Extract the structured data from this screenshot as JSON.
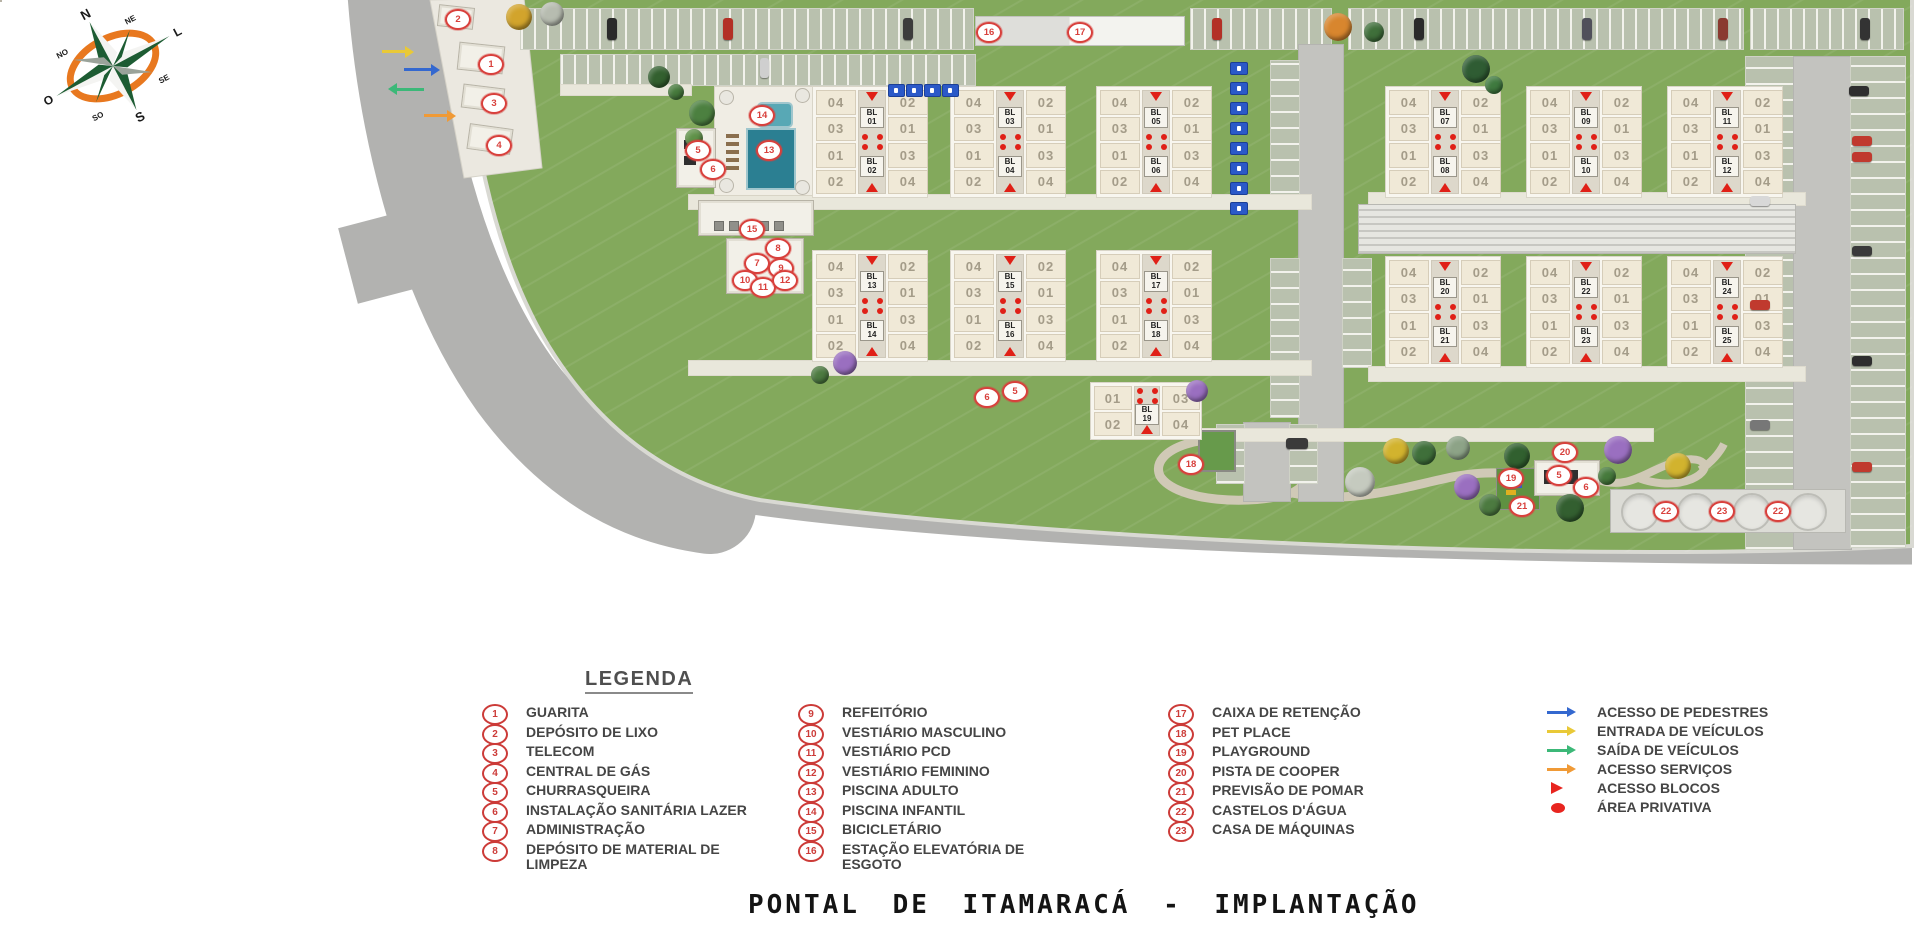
{
  "title": "PONTAL DE ITAMARACÁ - IMPLANTAÇÃO",
  "colors": {
    "accent_red": "#d8403c",
    "grass": "#83a95c",
    "road": "#b2b2b0",
    "building_cream": "#f0e9d7",
    "arrow_blue": "#3468cf",
    "arrow_yellow": "#e9c937",
    "arrow_green": "#3cb878",
    "arrow_orange": "#f09a36"
  },
  "compass": {
    "labels": [
      "N",
      "NE",
      "L",
      "SE",
      "S",
      "SO",
      "O",
      "NO"
    ]
  },
  "legend": {
    "title": "LEGENDA",
    "columns": [
      {
        "x": 482,
        "tx": 522,
        "items": [
          {
            "num": "1",
            "label": "GUARITA"
          },
          {
            "num": "2",
            "label": "DEPÓSITO DE LIXO"
          },
          {
            "num": "3",
            "label": "TELECOM"
          },
          {
            "num": "4",
            "label": "CENTRAL DE GÁS"
          },
          {
            "num": "5",
            "label": "CHURRASQUEIRA"
          },
          {
            "num": "6",
            "label": "INSTALAÇÃO SANITÁRIA LAZER"
          },
          {
            "num": "7",
            "label": "ADMINISTRAÇÃO"
          },
          {
            "num": "8",
            "label": "DEPÓSITO DE MATERIAL DE\nLIMPEZA"
          }
        ]
      },
      {
        "x": 798,
        "tx": 838,
        "items": [
          {
            "num": "9",
            "label": "REFEITÓRIO"
          },
          {
            "num": "10",
            "label": "VESTIÁRIO MASCULINO"
          },
          {
            "num": "11",
            "label": "VESTIÁRIO PCD"
          },
          {
            "num": "12",
            "label": "VESTIÁRIO FEMININO"
          },
          {
            "num": "13",
            "label": "PISCINA ADULTO"
          },
          {
            "num": "14",
            "label": "PISCINA INFANTIL"
          },
          {
            "num": "15",
            "label": "BICICLETÁRIO"
          },
          {
            "num": "16",
            "label": "ESTAÇÃO ELEVATÓRIA DE\nESGOTO"
          }
        ]
      },
      {
        "x": 1168,
        "tx": 1210,
        "items": [
          {
            "num": "17",
            "label": "CAIXA DE RETENÇÃO"
          },
          {
            "num": "18",
            "label": "PET PLACE"
          },
          {
            "num": "19",
            "label": "PLAYGROUND"
          },
          {
            "num": "20",
            "label": "PISTA DE COOPER"
          },
          {
            "num": "21",
            "label": "PREVISÃO DE POMAR"
          },
          {
            "num": "22",
            "label": "CASTELOS D'ÁGUA"
          },
          {
            "num": "23",
            "label": "CASA DE MÁQUINAS"
          }
        ]
      }
    ],
    "symbols": {
      "x": 1545,
      "tx": 1590,
      "items": [
        {
          "type": "arrow",
          "color": "#3468cf",
          "label": "ACESSO DE PEDESTRES"
        },
        {
          "type": "arrow",
          "color": "#e9c937",
          "label": "ENTRADA DE VEÍCULOS"
        },
        {
          "type": "arrow",
          "color": "#3cb878",
          "label": "SAÍDA DE VEÍCULOS"
        },
        {
          "type": "arrow",
          "color": "#f09a36",
          "label": "ACESSO SERVIÇOS"
        },
        {
          "type": "triangle",
          "color": "#e8251f",
          "label": "ACESSO BLOCOS"
        },
        {
          "type": "dot",
          "color": "#e8251f",
          "label": "ÁREA PRIVATIVA"
        }
      ]
    }
  },
  "plan": {
    "unit_left": [
      "04",
      "03",
      "01",
      "02"
    ],
    "unit_right": [
      "02",
      "01",
      "03",
      "04"
    ],
    "buildings": [
      {
        "x": 812,
        "y": 86,
        "top": "BL\n01",
        "bottom": "BL\n02"
      },
      {
        "x": 950,
        "y": 86,
        "top": "BL\n03",
        "bottom": "BL\n04"
      },
      {
        "x": 1096,
        "y": 86,
        "top": "BL\n05",
        "bottom": "BL\n06"
      },
      {
        "x": 1385,
        "y": 86,
        "top": "BL\n07",
        "bottom": "BL\n08"
      },
      {
        "x": 1526,
        "y": 86,
        "top": "BL\n09",
        "bottom": "BL\n10"
      },
      {
        "x": 1667,
        "y": 86,
        "top": "BL\n11",
        "bottom": "BL\n12"
      },
      {
        "x": 812,
        "y": 250,
        "top": "BL\n13",
        "bottom": "BL\n14"
      },
      {
        "x": 950,
        "y": 250,
        "top": "BL\n15",
        "bottom": "BL\n16"
      },
      {
        "x": 1096,
        "y": 250,
        "top": "BL\n17",
        "bottom": "BL\n18"
      },
      {
        "x": 1385,
        "y": 256,
        "top": "BL\n20",
        "bottom": "BL\n21"
      },
      {
        "x": 1526,
        "y": 256,
        "top": "BL\n22",
        "bottom": "BL\n23"
      },
      {
        "x": 1667,
        "y": 256,
        "top": "BL\n24",
        "bottom": "BL\n25"
      }
    ],
    "building19": {
      "x": 1090,
      "y": 382,
      "label": "BL\n19",
      "units_top": [
        "01",
        "03"
      ],
      "units_bottom": [
        "02",
        "04"
      ]
    },
    "markers": [
      {
        "n": "2",
        "x": 456,
        "y": 17
      },
      {
        "n": "1",
        "x": 489,
        "y": 62
      },
      {
        "n": "3",
        "x": 492,
        "y": 101
      },
      {
        "n": "4",
        "x": 497,
        "y": 143
      },
      {
        "n": "5",
        "x": 696,
        "y": 148
      },
      {
        "n": "6",
        "x": 711,
        "y": 167
      },
      {
        "n": "14",
        "x": 760,
        "y": 113
      },
      {
        "n": "13",
        "x": 767,
        "y": 148
      },
      {
        "n": "15",
        "x": 750,
        "y": 227
      },
      {
        "n": "8",
        "x": 776,
        "y": 246
      },
      {
        "n": "7",
        "x": 755,
        "y": 261
      },
      {
        "n": "9",
        "x": 779,
        "y": 266
      },
      {
        "n": "10",
        "x": 743,
        "y": 278
      },
      {
        "n": "11",
        "x": 761,
        "y": 285
      },
      {
        "n": "12",
        "x": 783,
        "y": 278
      },
      {
        "n": "16",
        "x": 987,
        "y": 30
      },
      {
        "n": "17",
        "x": 1078,
        "y": 30
      },
      {
        "n": "6",
        "x": 985,
        "y": 395
      },
      {
        "n": "5",
        "x": 1013,
        "y": 389
      },
      {
        "n": "18",
        "x": 1189,
        "y": 462
      },
      {
        "n": "20",
        "x": 1563,
        "y": 450
      },
      {
        "n": "19",
        "x": 1509,
        "y": 476
      },
      {
        "n": "5",
        "x": 1557,
        "y": 473
      },
      {
        "n": "6",
        "x": 1584,
        "y": 485
      },
      {
        "n": "21",
        "x": 1520,
        "y": 504
      },
      {
        "n": "22",
        "x": 1664,
        "y": 509
      },
      {
        "n": "23",
        "x": 1720,
        "y": 509
      },
      {
        "n": "22",
        "x": 1776,
        "y": 509
      }
    ],
    "arrows": [
      {
        "x": 382,
        "y": 50,
        "len": 24,
        "color": "#e9c937",
        "dir": "right",
        "name": "vehicle-entry-arrow"
      },
      {
        "x": 404,
        "y": 68,
        "len": 28,
        "color": "#3468cf",
        "dir": "right",
        "name": "pedestrian-access-arrow"
      },
      {
        "x": 396,
        "y": 88,
        "len": 28,
        "color": "#3cb878",
        "dir": "left",
        "name": "vehicle-exit-arrow"
      },
      {
        "x": 424,
        "y": 114,
        "len": 24,
        "color": "#f09a36",
        "dir": "right",
        "name": "service-access-arrow"
      }
    ],
    "trees": [
      {
        "x": 519,
        "y": 17,
        "d": 26,
        "c": "#d2a42c"
      },
      {
        "x": 552,
        "y": 14,
        "d": 24,
        "c": "#b7bcb0"
      },
      {
        "x": 1338,
        "y": 27,
        "d": 28,
        "c": "#d8862e"
      },
      {
        "x": 1374,
        "y": 32,
        "d": 20,
        "c": "#3f6f3a"
      },
      {
        "x": 659,
        "y": 77,
        "d": 22,
        "c": "#33602f"
      },
      {
        "x": 676,
        "y": 92,
        "d": 16,
        "c": "#467a3c"
      },
      {
        "x": 702,
        "y": 113,
        "d": 26,
        "c": "#4c8040"
      },
      {
        "x": 694,
        "y": 138,
        "d": 18,
        "c": "#5f9148"
      },
      {
        "x": 1476,
        "y": 69,
        "d": 28,
        "c": "#2f5c33"
      },
      {
        "x": 1494,
        "y": 85,
        "d": 18,
        "c": "#3f7a3f"
      },
      {
        "x": 845,
        "y": 363,
        "d": 24,
        "c": "#9a6fc0"
      },
      {
        "x": 820,
        "y": 375,
        "d": 18,
        "c": "#4c7a40"
      },
      {
        "x": 1197,
        "y": 391,
        "d": 22,
        "c": "#9a6fc0"
      },
      {
        "x": 1396,
        "y": 451,
        "d": 26,
        "c": "#d2b32e"
      },
      {
        "x": 1424,
        "y": 453,
        "d": 24,
        "c": "#3f6f3a"
      },
      {
        "x": 1458,
        "y": 448,
        "d": 24,
        "c": "#8da387"
      },
      {
        "x": 1360,
        "y": 482,
        "d": 30,
        "c": "#c5cabf"
      },
      {
        "x": 1467,
        "y": 487,
        "d": 26,
        "c": "#9a6fc0"
      },
      {
        "x": 1618,
        "y": 450,
        "d": 28,
        "c": "#9a6fc0"
      },
      {
        "x": 1678,
        "y": 466,
        "d": 26,
        "c": "#d2b32e"
      },
      {
        "x": 1517,
        "y": 456,
        "d": 26,
        "c": "#31602f"
      },
      {
        "x": 1570,
        "y": 508,
        "d": 28,
        "c": "#335f30"
      },
      {
        "x": 1490,
        "y": 505,
        "d": 22,
        "c": "#4c7a40"
      },
      {
        "x": 1607,
        "y": 476,
        "d": 18,
        "c": "#467a3c"
      }
    ],
    "cars": [
      {
        "x": 607,
        "y": 18,
        "w": 10,
        "h": 22,
        "c": "#2a2a2a"
      },
      {
        "x": 723,
        "y": 18,
        "w": 10,
        "h": 22,
        "c": "#b33026"
      },
      {
        "x": 903,
        "y": 18,
        "w": 10,
        "h": 22,
        "c": "#3c3c3c"
      },
      {
        "x": 1212,
        "y": 18,
        "w": 10,
        "h": 22,
        "c": "#b33026"
      },
      {
        "x": 1414,
        "y": 18,
        "w": 10,
        "h": 22,
        "c": "#2a2a2a"
      },
      {
        "x": 1582,
        "y": 18,
        "w": 10,
        "h": 22,
        "c": "#50505a"
      },
      {
        "x": 1718,
        "y": 18,
        "w": 10,
        "h": 22,
        "c": "#8a3a30"
      },
      {
        "x": 1860,
        "y": 18,
        "w": 10,
        "h": 22,
        "c": "#333333"
      },
      {
        "x": 760,
        "y": 58,
        "w": 9,
        "h": 20,
        "c": "#cfcfcf"
      },
      {
        "x": 1849,
        "y": 86,
        "w": 20,
        "h": 10,
        "c": "#2e2e2e"
      },
      {
        "x": 1852,
        "y": 136,
        "w": 20,
        "h": 10,
        "c": "#c03a2e"
      },
      {
        "x": 1852,
        "y": 152,
        "w": 20,
        "h": 10,
        "c": "#c03a2e"
      },
      {
        "x": 1750,
        "y": 196,
        "w": 20,
        "h": 10,
        "c": "#d8d8d8"
      },
      {
        "x": 1852,
        "y": 246,
        "w": 20,
        "h": 10,
        "c": "#3a3a3a"
      },
      {
        "x": 1750,
        "y": 300,
        "w": 20,
        "h": 10,
        "c": "#c03a2e"
      },
      {
        "x": 1852,
        "y": 356,
        "w": 20,
        "h": 10,
        "c": "#2e2e2e"
      },
      {
        "x": 1750,
        "y": 420,
        "w": 20,
        "h": 10,
        "c": "#777777"
      },
      {
        "x": 1852,
        "y": 462,
        "w": 20,
        "h": 10,
        "c": "#c03a2e"
      },
      {
        "x": 1286,
        "y": 438,
        "w": 22,
        "h": 11,
        "c": "#3a3a3a"
      }
    ],
    "handicap_column": {
      "x": 1230,
      "y0": 62,
      "step": 20,
      "count": 8
    },
    "handicap_row": {
      "y": 84,
      "xs": [
        888,
        906,
        924,
        942
      ]
    },
    "bike_racks": {
      "y": 221,
      "xs": [
        714,
        729,
        744,
        759,
        774
      ]
    },
    "tanks": {
      "cy": 510,
      "cxs": [
        1638,
        1694,
        1750,
        1806
      ],
      "d": 34
    }
  }
}
